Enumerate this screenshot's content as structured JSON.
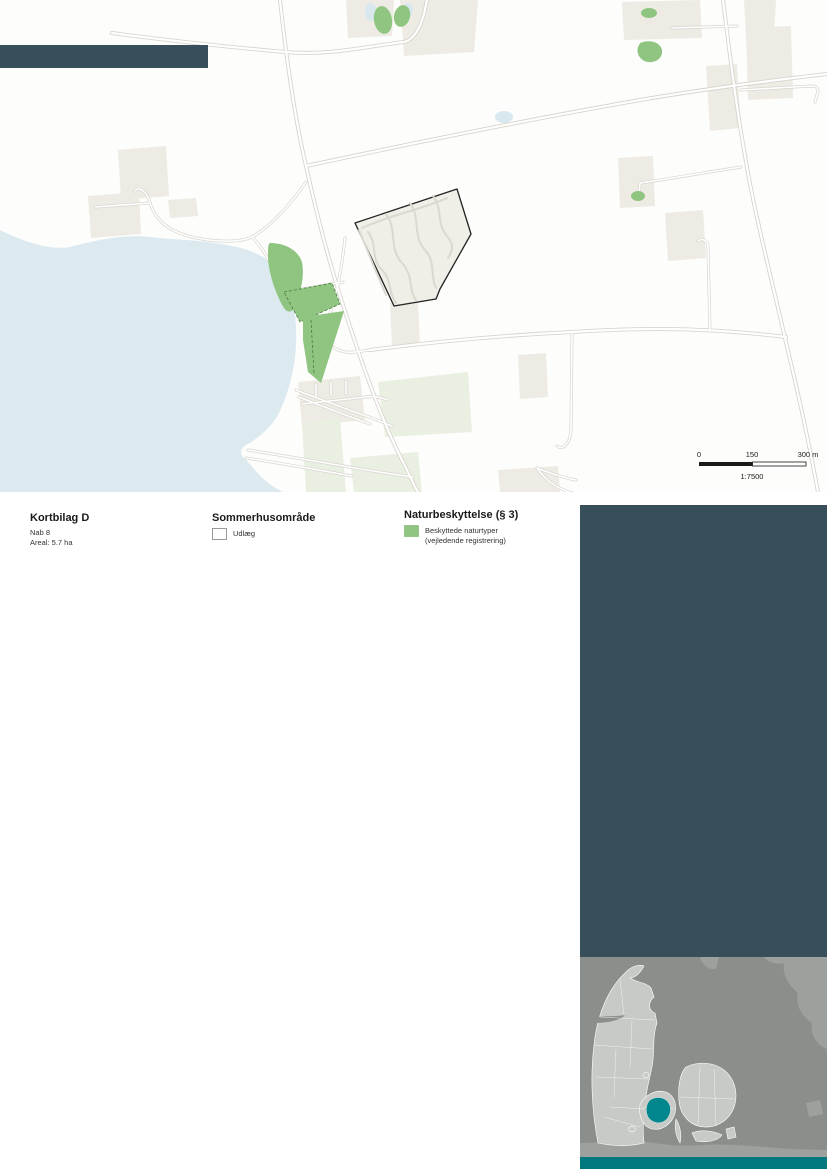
{
  "legend": {
    "kortbilag": {
      "title": "Kortbilag D",
      "line1": "Nab 8",
      "line2": "Areal: 5.7 ha"
    },
    "sommerhus": {
      "title": "Sommerhusområde",
      "item": "Udlæg"
    },
    "natur": {
      "title": "Naturbeskyttelse (§ 3)",
      "item_line1": "Beskyttede naturtyper",
      "item_line2": "(vejledende registrering)"
    }
  },
  "map": {
    "scalebar": {
      "start": "0",
      "mid": "150",
      "end": "300 m",
      "ratio": "1:7500"
    }
  },
  "colors": {
    "slate": "#374F5B",
    "teal_accent": "#00868D",
    "teal_bar": "#00787E",
    "water": "#DCEAF0",
    "green": "#8FC581",
    "pale_green": "#E9F0E1",
    "beige": "#EDEBE4",
    "road_casing": "#D8D5CE",
    "site_outline": "#222222",
    "swatch_border": "#999999",
    "inset_sea": "#8A8F8B",
    "inset_land": "#C7CAC6",
    "inset_foreign": "#9CA19D"
  }
}
